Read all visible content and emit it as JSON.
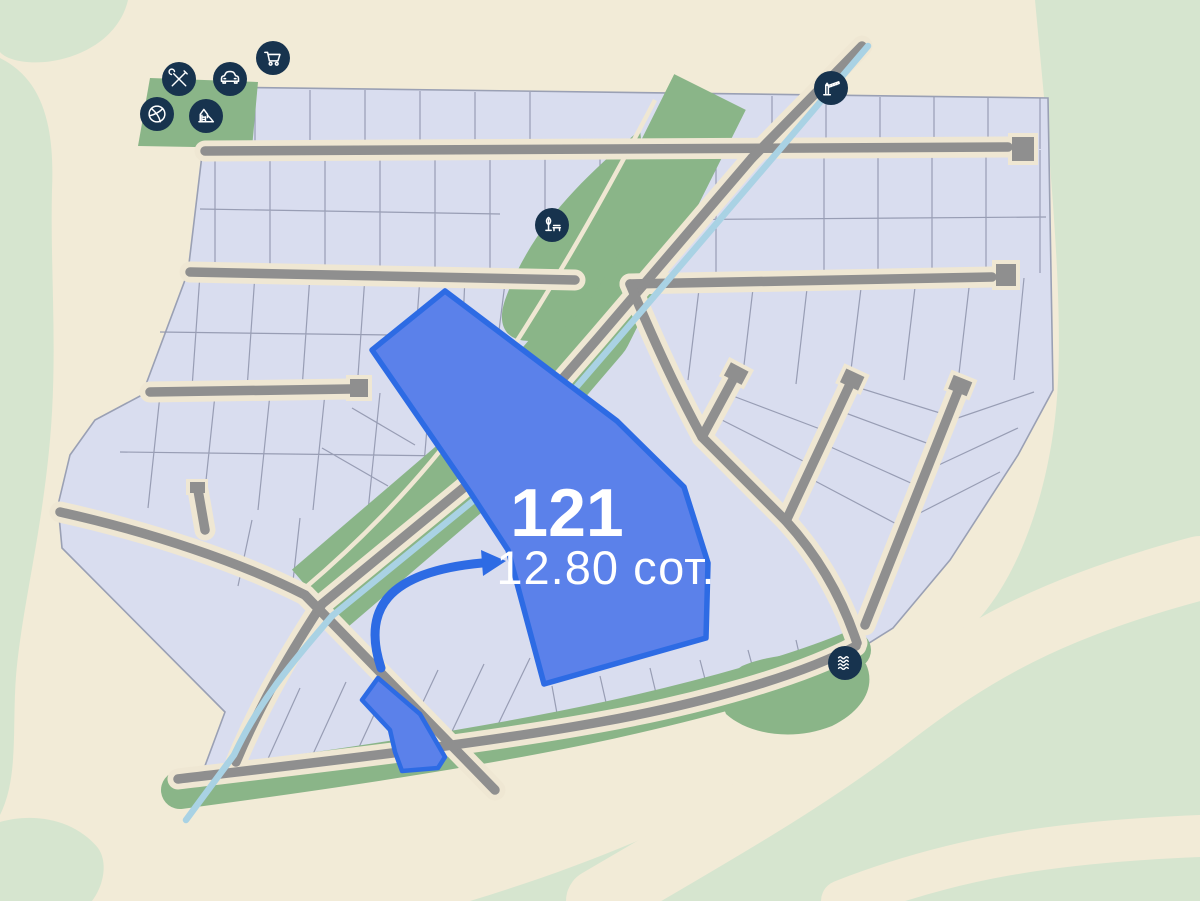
{
  "map": {
    "highlighted_plot": {
      "number": "121",
      "area": "12.80 сот."
    },
    "markers": [
      {
        "name": "workshop-tools-marker"
      },
      {
        "name": "car-marker"
      },
      {
        "name": "shopping-cart-marker"
      },
      {
        "name": "basketball-marker"
      },
      {
        "name": "playground-marker"
      },
      {
        "name": "entrance-barrier-marker"
      },
      {
        "name": "park-marker"
      },
      {
        "name": "water-marker"
      }
    ],
    "colors": {
      "background": "#f2ebd7",
      "greenery_light": "#d6e5cf",
      "greenery": "#8ab588",
      "plot_fill": "#d9ddef",
      "plot_line": "#9096ad",
      "road": "#8f8f8f",
      "road_edge": "#efe7d3",
      "stream": "#a9d2e4",
      "marker_bg": "#17334e",
      "marker_glyph": "#ffffff",
      "highlight_fill": "#5b81ea",
      "highlight_stroke": "#2d6be4",
      "label_text": "#ffffff"
    }
  }
}
